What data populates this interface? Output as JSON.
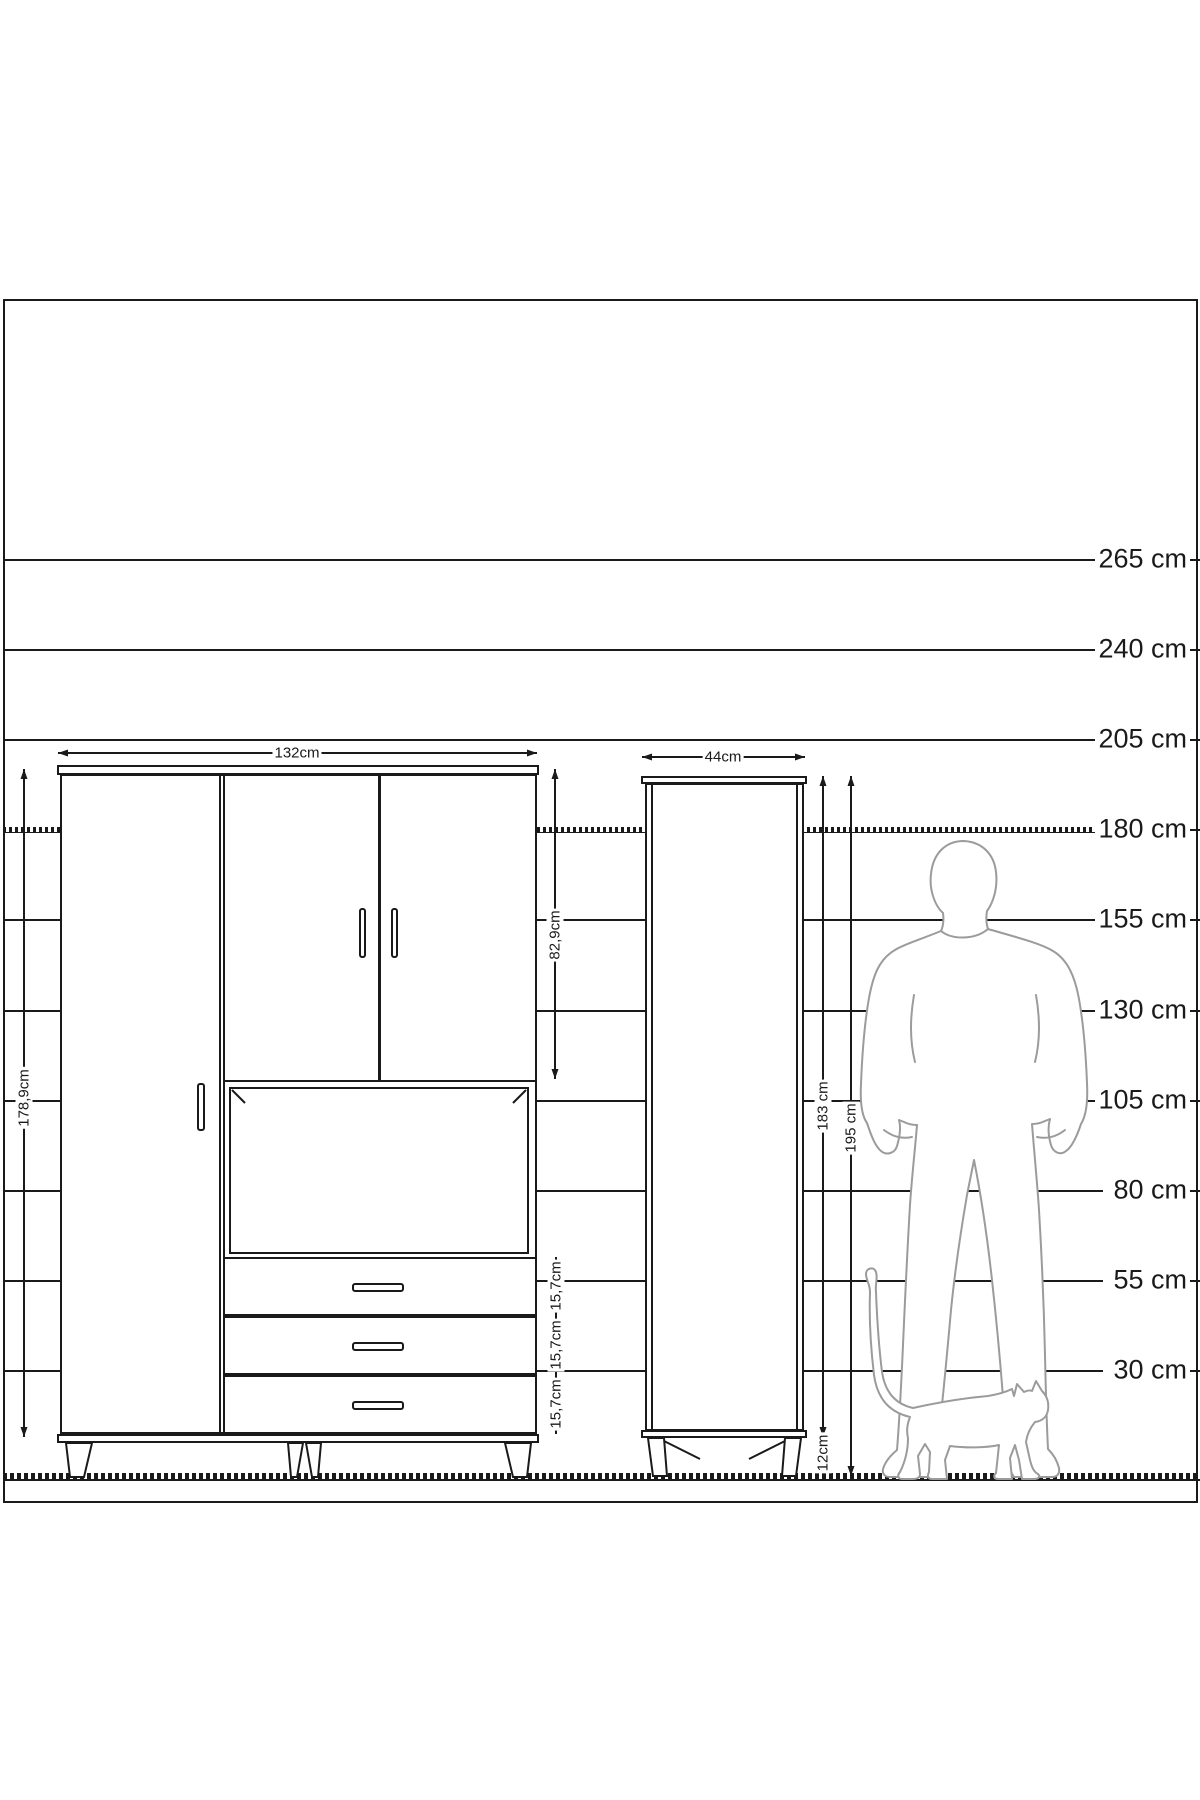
{
  "title": "furniture-dimension-diagram",
  "colors": {
    "line": "#1a1a1a",
    "silhouette": "#9b9b9b",
    "background": "#ffffff"
  },
  "drawing_area": {
    "x": 3,
    "y": 299,
    "w": 1191,
    "h": 1200
  },
  "ruler": {
    "unit": "cm",
    "line_left": 3,
    "line_right": 1103,
    "label_right": 10,
    "tick_left": 1188,
    "tick_right": 1200,
    "lines": [
      {
        "label": "265 cm",
        "y": 560,
        "style": "solid"
      },
      {
        "label": "240 cm",
        "y": 650,
        "style": "solid"
      },
      {
        "label": "205 cm",
        "y": 740,
        "style": "solid"
      },
      {
        "label": "180 cm",
        "y": 830,
        "style": "hatched"
      },
      {
        "label": "155 cm",
        "y": 920,
        "style": "solid"
      },
      {
        "label": "130 cm",
        "y": 1011,
        "style": "solid"
      },
      {
        "label": "105 cm",
        "y": 1101,
        "style": "solid"
      },
      {
        "label": "80 cm",
        "y": 1191,
        "style": "solid"
      },
      {
        "label": "55 cm",
        "y": 1281,
        "style": "solid"
      },
      {
        "label": "30 cm",
        "y": 1371,
        "style": "solid"
      }
    ],
    "floor": {
      "y": 1477,
      "x1": 3,
      "x2": 1200,
      "style": "hatched-thick"
    }
  },
  "cabinets": {
    "large_cabinet": {
      "name": "large-cabinet",
      "parts": [
        {
          "name": "top-board",
          "type": "box",
          "x": 57,
          "y": 765,
          "w": 482,
          "h": 10
        },
        {
          "name": "body",
          "type": "box",
          "x": 60,
          "y": 774,
          "w": 477,
          "h": 660
        },
        {
          "name": "left-door-divider-a",
          "type": "fill",
          "x": 219,
          "y": 776,
          "w": 2,
          "h": 656
        },
        {
          "name": "left-door-divider-b",
          "type": "fill",
          "x": 223,
          "y": 776,
          "w": 2,
          "h": 656
        },
        {
          "name": "top-doors-bottom",
          "type": "fill",
          "x": 225,
          "y": 1080,
          "w": 310,
          "h": 2
        },
        {
          "name": "top-door-divider",
          "type": "fill",
          "x": 378,
          "y": 776,
          "w": 3,
          "h": 306
        },
        {
          "name": "compartment-inner",
          "type": "box",
          "x": 229,
          "y": 1087,
          "w": 300,
          "h": 167
        },
        {
          "name": "drawers-top-line",
          "type": "fill",
          "x": 225,
          "y": 1257,
          "w": 310,
          "h": 2
        },
        {
          "name": "drawer-separator-1",
          "type": "fill",
          "x": 225,
          "y": 1314,
          "w": 310,
          "h": 4
        },
        {
          "name": "drawer-separator-2",
          "type": "fill",
          "x": 225,
          "y": 1373,
          "w": 310,
          "h": 4
        },
        {
          "name": "bottom-board",
          "type": "box",
          "x": 57,
          "y": 1434,
          "w": 482,
          "h": 9
        }
      ],
      "handles": [
        {
          "name": "left-door-handle",
          "x": 197,
          "y": 1083,
          "w": 8,
          "h": 48
        },
        {
          "name": "top-door-handle-left",
          "x": 359,
          "y": 908,
          "w": 7,
          "h": 50
        },
        {
          "name": "top-door-handle-right",
          "x": 391,
          "y": 908,
          "w": 7,
          "h": 50
        },
        {
          "name": "drawer-handle-1",
          "x": 352,
          "y": 1283,
          "w": 52,
          "h": 9
        },
        {
          "name": "drawer-handle-2",
          "x": 352,
          "y": 1342,
          "w": 52,
          "h": 9
        },
        {
          "name": "drawer-handle-3",
          "x": 352,
          "y": 1401,
          "w": 52,
          "h": 9
        }
      ]
    },
    "tall_cabinet": {
      "name": "tall-cabinet",
      "parts": [
        {
          "name": "top-board",
          "type": "box",
          "x": 641,
          "y": 776,
          "w": 166,
          "h": 8
        },
        {
          "name": "body",
          "type": "box",
          "x": 645,
          "y": 783,
          "w": 159,
          "h": 648
        },
        {
          "name": "door-edge-left",
          "type": "fill",
          "x": 651,
          "y": 785,
          "w": 2,
          "h": 644
        },
        {
          "name": "door-edge-right",
          "type": "fill",
          "x": 796,
          "y": 785,
          "w": 2,
          "h": 644
        },
        {
          "name": "bottom-board",
          "type": "box",
          "x": 641,
          "y": 1430,
          "w": 166,
          "h": 8
        }
      ],
      "handles": []
    }
  },
  "legs": {
    "polygons": [
      {
        "name": "large-cabinet-leg-outer-left",
        "points": "66,1443 92,1443 84,1477 70,1477"
      },
      {
        "name": "large-cabinet-leg-mid-left",
        "points": "288,1443 303,1443 297,1477 291,1477"
      },
      {
        "name": "large-cabinet-leg-mid-right",
        "points": "306,1443 321,1443 318,1477 312,1477"
      },
      {
        "name": "large-cabinet-leg-outer-right",
        "points": "505,1443 531,1443 527,1477 513,1477"
      },
      {
        "name": "tall-cabinet-leg-left",
        "points": "648,1438 664,1438 667,1476 653,1476"
      },
      {
        "name": "tall-cabinet-leg-right",
        "points": "785,1438 801,1438 796,1476 782,1476"
      }
    ],
    "braces": [
      {
        "name": "tall-cabinet-leg-brace-left",
        "x1": 664,
        "y1": 1441,
        "x2": 700,
        "y2": 1459
      },
      {
        "name": "tall-cabinet-leg-brace-right",
        "x1": 785,
        "y1": 1441,
        "x2": 749,
        "y2": 1459
      }
    ],
    "corner_marks": [
      {
        "name": "compartment-corner-left",
        "x1": 232,
        "y1": 1090,
        "x2": 245,
        "y2": 1103
      },
      {
        "name": "compartment-corner-right",
        "x1": 526,
        "y1": 1090,
        "x2": 513,
        "y2": 1103
      }
    ]
  },
  "dimensions": [
    {
      "id": "width-large",
      "dir": "h",
      "y": 753,
      "from": 58,
      "to": 537,
      "label": "132cm",
      "lx": 297,
      "ly": 753
    },
    {
      "id": "width-tall",
      "dir": "h",
      "y": 757,
      "from": 642,
      "to": 805,
      "label": "44cm",
      "lx": 723,
      "ly": 757
    },
    {
      "id": "height-large",
      "dir": "v",
      "x": 24,
      "from": 769,
      "to": 1437,
      "label": "178,9cm",
      "lx": 24,
      "ly": 1098
    },
    {
      "id": "upper-doors",
      "dir": "v",
      "x": 555,
      "from": 769,
      "to": 1079,
      "label": "82,9cm",
      "lx": 555,
      "ly": 935
    },
    {
      "id": "drawer-1",
      "dir": "v",
      "x": 556,
      "from": 1257,
      "to": 1316,
      "label": "15,7cm",
      "lx": 556,
      "ly": 1286
    },
    {
      "id": "drawer-2",
      "dir": "v",
      "x": 556,
      "from": 1316,
      "to": 1375,
      "label": "15,7cm",
      "lx": 556,
      "ly": 1345
    },
    {
      "id": "drawer-3",
      "dir": "v",
      "x": 556,
      "from": 1375,
      "to": 1434,
      "label": "15,7cm",
      "lx": 556,
      "ly": 1404
    },
    {
      "id": "body-tall",
      "dir": "v",
      "x": 823,
      "from": 776,
      "to": 1437,
      "label": "183 cm",
      "lx": 823,
      "ly": 1106
    },
    {
      "id": "legs-tall",
      "dir": "v",
      "x": 823,
      "from": 1437,
      "to": 1476,
      "label": "12cm",
      "lx": 823,
      "ly": 1453
    },
    {
      "id": "total-tall",
      "dir": "v",
      "x": 851,
      "from": 776,
      "to": 1476,
      "label": "195 cm",
      "lx": 851,
      "ly": 1128
    }
  ],
  "silhouettes": {
    "man": {
      "name": "man-silhouette",
      "outline": "M 964 841 C 982 842 994 854 996 872 C 998 888 993 903 987 911 C 986 917 986 923 988 929 C 1012 936 1040 943 1053 951 C 1068 960 1075 977 1079 999 C 1084 1027 1086 1058 1087 1083 C 1088 1102 1086 1116 1081 1124 C 1077 1136 1072 1147 1066 1151 C 1060 1156 1053 1152 1051 1145 C 1048 1135 1048 1126 1050 1119 L 1045 1121 C 1041 1123 1036 1124 1032 1124 C 1034 1150 1037 1180 1039 1210 C 1042 1260 1044 1310 1045 1355 C 1046 1400 1047 1430 1048 1449 C 1052 1453 1057 1460 1059 1468 C 1060 1474 1057 1477 1052 1477 L 1014 1477 C 1009 1470 1007 1461 1007 1452 L 1004 1410 C 1001 1370 997 1325 992 1280 C 987 1235 981 1195 974 1160 L 967 1195 C 961 1230 955 1270 951 1310 C 947 1355 943 1398 939 1432 L 938 1467 C 938 1473 935 1477 929 1477 L 890 1477 C 885 1477 882 1474 883 1469 C 885 1462 891 1455 897 1450 C 899 1425 901 1390 903 1345 C 905 1300 907 1255 910 1205 C 912 1175 915 1150 917 1125 C 913 1125 908 1124 904 1122 L 899 1120 C 901 1127 900 1136 897 1146 C 895 1153 887 1156 881 1151 C 875 1146 871 1135 867 1123 C 862 1116 860 1103 861 1084 C 862 1058 864 1026 869 998 C 873 976 879 959 895 950 C 902 945 919 940 941 931 C 943 927 944 920 943 913 C 935 906 929 890 931 874 C 933 854 945 841 964 841 Z",
      "details": [
        "M 914 995 C 910 1018 910 1042 915 1062",
        "M 1036 995 C 1040 1018 1040 1042 1035 1062",
        "M 884 1130 C 893 1137 903 1139 912 1137",
        "M 1065 1130 C 1056 1137 1046 1139 1037 1137",
        "M 941 931 C 952 940 975 940 988 929"
      ]
    },
    "cat": {
      "name": "cat-silhouette",
      "outline": "M 913 1408 C 895 1404 885 1392 882 1372 C 879 1348 877 1318 876 1292 C 875 1284 878 1278 876 1272 C 874 1266 866 1268 866 1274 C 866 1280 870 1284 870 1292 C 869 1320 871 1350 874 1375 C 877 1397 888 1412 910 1417 C 908 1422 906 1430 908 1438 C 908 1450 905 1462 900 1472 C 897 1475 898 1479 902 1479 L 913 1479 C 916 1479 920 1478 920 1474 L 918 1456 L 925 1444 L 930 1452 L 929 1472 C 927 1476 928 1479 932 1479 L 947 1479 L 945 1460 L 950 1446 C 965 1448 985 1448 999 1445 L 996 1473 C 993 1476 994 1479 998 1479 L 1012 1479 L 1010 1458 L 1015 1445 L 1019 1460 L 1022 1479 L 1034 1479 C 1038 1479 1041 1477 1038 1474 C 1034 1472 1032 1468 1030 1460 L 1026 1442 C 1027 1435 1030 1428 1035 1422 C 1042 1421 1047 1417 1048 1410 C 1049 1403 1047 1396 1042 1391 L 1036 1381 L 1032 1391 C 1030 1390 1028 1390 1024 1392 L 1017 1384 L 1014 1396 L 1012 1389 C 1008 1391 1000 1394 988 1396 C 965 1398 940 1402 913 1408 Z"
    }
  }
}
